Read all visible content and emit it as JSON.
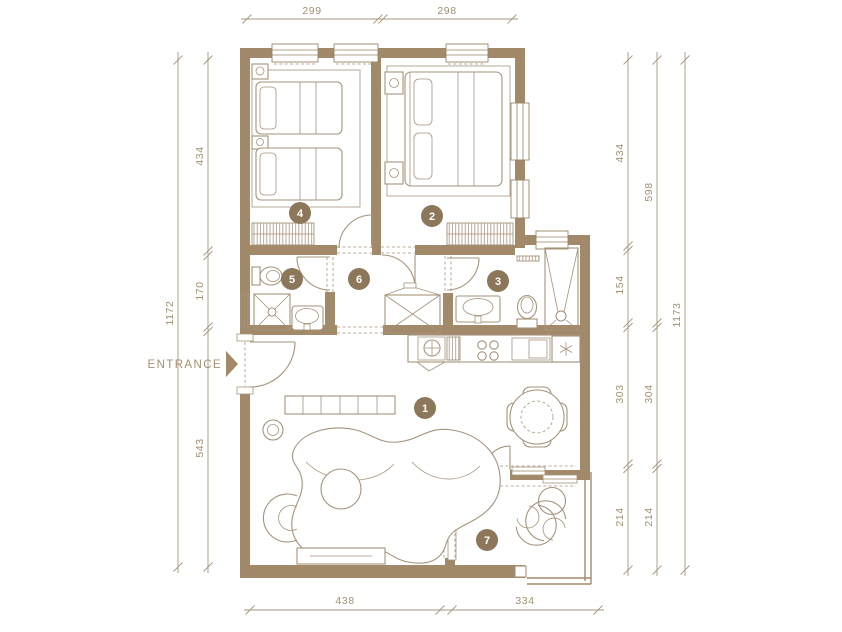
{
  "meta": {
    "title": "Apartment floor plan"
  },
  "palette": {
    "wall": "#a1896a",
    "furniture_line": "#a6937b",
    "dimension_line": "#a6967c",
    "dimension_text": "#a29070",
    "badge": "#8d775a",
    "badge_text": "#ffffff",
    "background": "#ffffff"
  },
  "entrance": {
    "label": "ENTRANCE"
  },
  "rooms": [
    {
      "id": "living-kitchen",
      "number": "1"
    },
    {
      "id": "bedroom-master",
      "number": "2"
    },
    {
      "id": "bathroom-main",
      "number": "3"
    },
    {
      "id": "bedroom-twin",
      "number": "4"
    },
    {
      "id": "shower-room",
      "number": "5"
    },
    {
      "id": "hallway",
      "number": "6"
    },
    {
      "id": "balcony",
      "number": "7"
    }
  ],
  "dimensions": {
    "top": [
      "299",
      "298"
    ],
    "bottom": [
      "438",
      "334"
    ],
    "left_inner": [
      "434",
      "170",
      "543"
    ],
    "left_total": "1172",
    "right_inner": [
      "434",
      "154",
      "303",
      "214"
    ],
    "right_middle": [
      "598",
      "304",
      "214"
    ],
    "right_total": "1173"
  }
}
